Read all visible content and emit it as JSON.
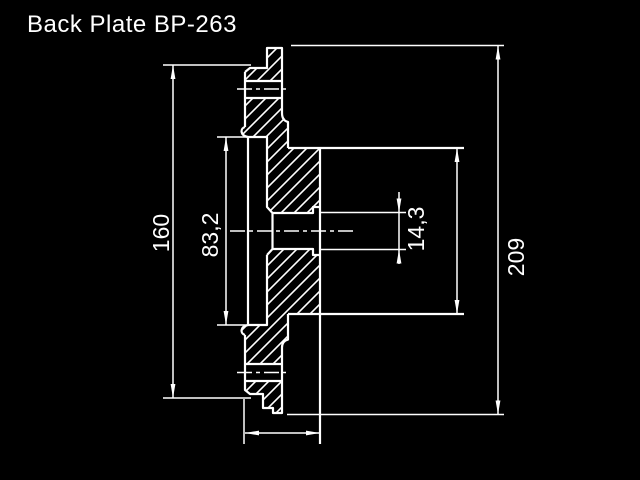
{
  "title": "Back Plate BP-263",
  "colors": {
    "background": "#000000",
    "line": "#ffffff",
    "text": "#ffffff"
  },
  "dimensions": {
    "flange_diameter": {
      "label": "160"
    },
    "register_diameter": {
      "label": "83,2"
    },
    "bore_diameter": {
      "label": "14,3"
    },
    "overall_diameter": {
      "label": "209"
    }
  }
}
